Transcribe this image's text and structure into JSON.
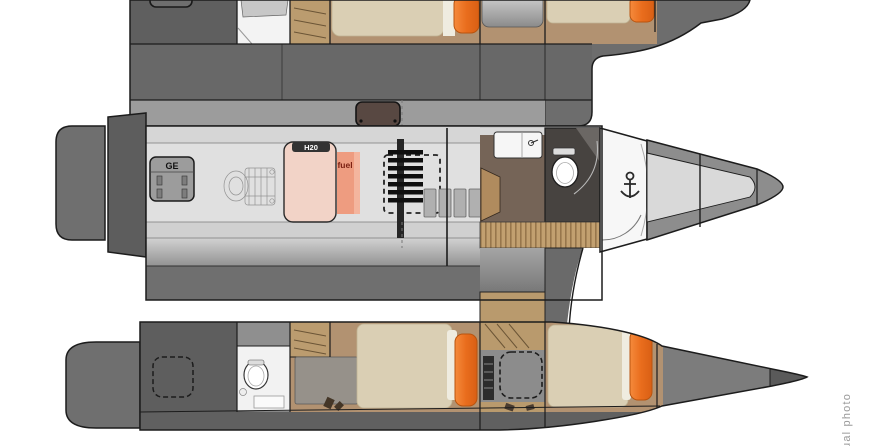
{
  "figure": {
    "kind": "catamaran deck floor plan, top view, bow pointing right",
    "photo_credit": "ual photo"
  },
  "labels": {
    "generator": "GE",
    "water_tank": "H20",
    "fuel_tank": "fuel"
  },
  "colors": {
    "background": "#ffffff",
    "outline": "#1c1c1c",
    "hull_dark": "#6d6d6d",
    "hull_block": "#5f5f5f",
    "coachroof_strip": "#9c9c9c",
    "deck_light": "#e0e0e0",
    "wood": "#bb9c6f",
    "wood_slats": "#c2a070",
    "bed_duvet": "#dacfb4",
    "pillow_orange": "#ee7428",
    "water_tank_pink": "#f2d3c7",
    "fuel_salmon": "#ee9c80",
    "hatch_brown": "#584842",
    "galley_floor": "#756457",
    "bathroom_dark": "#474340",
    "credit_gray": "#9a9a9a"
  },
  "icons": {
    "anchor": "anchor-icon",
    "toilet": "toilet-icon",
    "sink": "sink-icon",
    "ladder": "companionway-ladder-icon",
    "engine": "engine-sketch-icon",
    "deck_hatch": "deck-hatch-icon",
    "stairs": "steps-icon"
  }
}
